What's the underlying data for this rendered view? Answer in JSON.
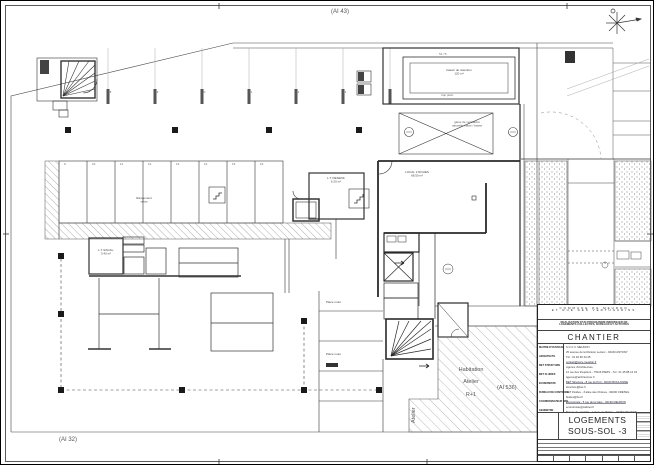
{
  "sheet": {
    "ai43": "(AI 43)",
    "ai32": "(AI 32)",
    "ai536": "(AI 536)"
  },
  "plan": {
    "zone_habitation": {
      "line1": "Habitation",
      "line2": "Atelier",
      "line3": "R+1"
    },
    "atelier_vertical": "Atelier",
    "dim_top": "54.75",
    "rooms": {
      "local_2_roues": {
        "name": "LOCAL 2 ROUES",
        "area": "68.50 m²"
      },
      "lt_desenfumage": {
        "name": "L.T. DESENF.",
        "area": "6.20 m²"
      },
      "lt_escalier": {
        "name": "L.T. ESCAL.",
        "area": "3.40 m²"
      },
      "bassin": {
        "name": "bassin de rétention",
        "area": "120 m³",
        "note": "trop plein"
      },
      "gaine": {
        "text": "gaine de ventilation naturelle haute / basse"
      },
      "rangement": {
        "line1": "Rangement",
        "line2": "vélos"
      },
      "place_moto_1": "Place moto",
      "place_moto_2": "Place moto"
    },
    "parking": {
      "row1": [
        "18",
        "19",
        "20",
        "21",
        "22",
        "23"
      ],
      "row2": [
        "9",
        "10",
        "11",
        "12",
        "13",
        "14",
        "15",
        "16"
      ]
    }
  },
  "titleblock": {
    "commune_line1": "COMMUNE DE MEUDON",
    "commune_line2": "ET RUE DES VERTUGADINS",
    "subtitle_line1": "REALISATION D'UN PROGRAMME IMMOBILIER DE",
    "subtitle_line2": "LOGEMENTS COLLECTIFS, BUREAUX ET ACTIVITES",
    "section_title": "CHANTIER",
    "left_labels": [
      "MAITRE D'OUVRAGE",
      "ARCHITECTE",
      "BET STRUCTURE",
      "BET FLUIDES",
      "ECONOMISTE",
      "BUREAU DE CONTROLE",
      "COORDONNATEUR SPS",
      "GEOMETRE"
    ],
    "right_lines": [
      "S.C.C.V. MEUDON",
      "25 avenue de la Division Leclerc - 92160 ANTONY",
      "Tél : 01 46 66 23 45",
      "contact@sccv-meudon.fr",
      "Agence d'Architecture",
      "12 rue des Peupliers - 75013 PARIS - Tél : 01 45 88 12 34",
      "agence@architecture.fr",
      "BET Structure - 8 rue du Port - 92100 BOULOGNE",
      "structure@bet.fr",
      "BET Fluides - 3 allée des Chênes - 94000 CRETEIL",
      "fluides@bet.fr",
      "Economiste - 5 rue de la Gare - 92190 MEUDON",
      "economiste@cabinet.fr",
      "Bureau de contrôle - 1 place de l'Eglise - 92360 MEUDON",
      "controle@bureau.fr",
      "SPS - 9 avenue du Maréchal Juin - 92100 BOULOGNE",
      "sps@coordination.fr"
    ],
    "drawing_title_line1": "LOGEMENTS",
    "drawing_title_line2": "SOUS-SOL -3"
  }
}
